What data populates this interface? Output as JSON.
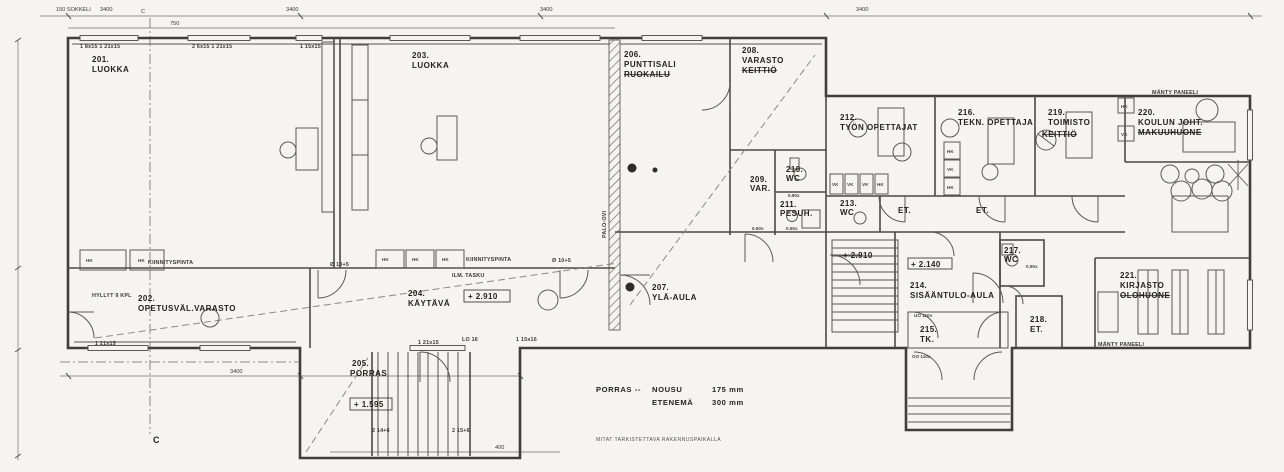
{
  "drawing": {
    "rooms": [
      {
        "number": "201.",
        "name": "LUOKKA"
      },
      {
        "number": "202.",
        "name": "OPETUSVÄL.VARASTO"
      },
      {
        "number": "203.",
        "name": "LUOKKA"
      },
      {
        "number": "204.",
        "name": "KÄYTÄVÄ"
      },
      {
        "number": "205.",
        "name": "PORRAS"
      },
      {
        "number": "206.",
        "name": "PUNTTISALI",
        "name2": "RUOKAILU"
      },
      {
        "number": "207.",
        "name": "YLÄ-AULA"
      },
      {
        "number": "208.",
        "name": "VARASTO",
        "name2": "KEITTIÖ"
      },
      {
        "number": "209.",
        "name": "VAR."
      },
      {
        "number": "210.",
        "name": "WC"
      },
      {
        "number": "211.",
        "name": "PESUH."
      },
      {
        "number": "212.",
        "name": "TYÖN OPETTAJAT"
      },
      {
        "number": "213.",
        "name": "WC"
      },
      {
        "number": "214.",
        "name": "SISÄÄNTULO-AULA"
      },
      {
        "number": "215.",
        "name": "TK."
      },
      {
        "number": "216.",
        "name": "TEKN. OPETTAJA"
      },
      {
        "number": "217.",
        "name": "WC"
      },
      {
        "number": "218.",
        "name": "ET."
      },
      {
        "number": "219.",
        "name": "TOIMISTO",
        "name2": "KEITTIÖ"
      },
      {
        "number": "220.",
        "name": "KOULUN JOHT.",
        "name2": "MAKUUHUONE"
      },
      {
        "number": "221.",
        "name": "KIRJASTO",
        "name2": "OLOHUONE"
      }
    ],
    "elevations": {
      "k204": "+ 2.910",
      "aula": "+ 2.910",
      "entry": "+ 2.140",
      "stair": "+ 1.595"
    },
    "stair_note": {
      "title": "PORRAS --",
      "rise_label": "NOUSU",
      "rise": "175 mm",
      "run_label": "ETENEMÄ",
      "run": "300 mm"
    },
    "check_note": "MITAT TARKISTETTAVA RAKENNUSPAIKALLA",
    "section_marker": "C",
    "dims_top": [
      "150 SOKKELI",
      "3400",
      "750",
      "3400",
      "3400",
      "3400"
    ],
    "dims_bottom": [
      "3400",
      "400"
    ],
    "window_codes": {
      "w1": "1 8x15   1 21x15",
      "w2": "2 6x15   1 21x15",
      "w3": "1 15x15",
      "w4": "1 21x15",
      "w5": "1 21x15",
      "w6": "LO 16",
      "w7": "1 15x16",
      "w8": "2 14+6",
      "w9": "2 15+6"
    },
    "small": {
      "et": "ET.",
      "hk": "HK",
      "vk": "VK"
    },
    "annotations": {
      "palo_ovi": "PALO-OVI",
      "hyllyt": "HYLLYT 9 KPL",
      "kiinnityspinta": "KIINNITYSPINTA",
      "ilm_tasku": "ILM. TASKU",
      "manty_paneeli": "MÄNTY PANEELI",
      "d10": "Ø 10+5",
      "d090": "0.90x",
      "d060": "0.60x",
      "uo": "UO 110x",
      "oo": "OO 110x"
    }
  }
}
